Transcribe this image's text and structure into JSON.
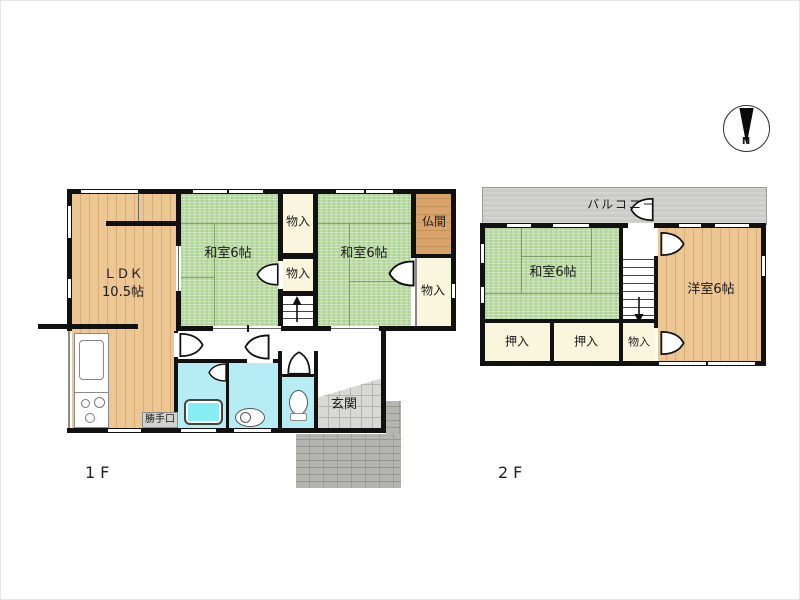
{
  "plan_title": "2-story house floor plan",
  "floor1": {
    "floor_label": "1F",
    "ldk": {
      "line1": "ＬＤＫ",
      "line2": "10.5帖"
    },
    "washitsu_a": "和室6帖",
    "washitsu_b": "和室6帖",
    "butsuma": "仏間",
    "monoire_top": "物入",
    "monoire_mid": "物入",
    "monoire_side": "物入",
    "genkan": "玄関",
    "katteguchi": "勝手口"
  },
  "floor2": {
    "floor_label": "2F",
    "balcony": "バルコニー",
    "washitsu": "和室6帖",
    "youshitsu": "洋室6帖",
    "oshiire_a": "押入",
    "oshiire_b": "押入",
    "monoire": "物入"
  },
  "compass": {
    "north": "N"
  },
  "colors": {
    "tatami_green": "#bcdca6",
    "wood_floor": "#ecc693",
    "altar_wood": "#d9a46c",
    "closet_cream": "#faf5dd",
    "wet_area_cyan": "#b6ecf4",
    "bathtub_cyan": "#86eef2",
    "balcony_gray": "#cbcbc7",
    "entrance_tile_gray": "#d8d8d4",
    "porch_brick_gray": "#b4b4b0",
    "wall_black": "#111111"
  }
}
